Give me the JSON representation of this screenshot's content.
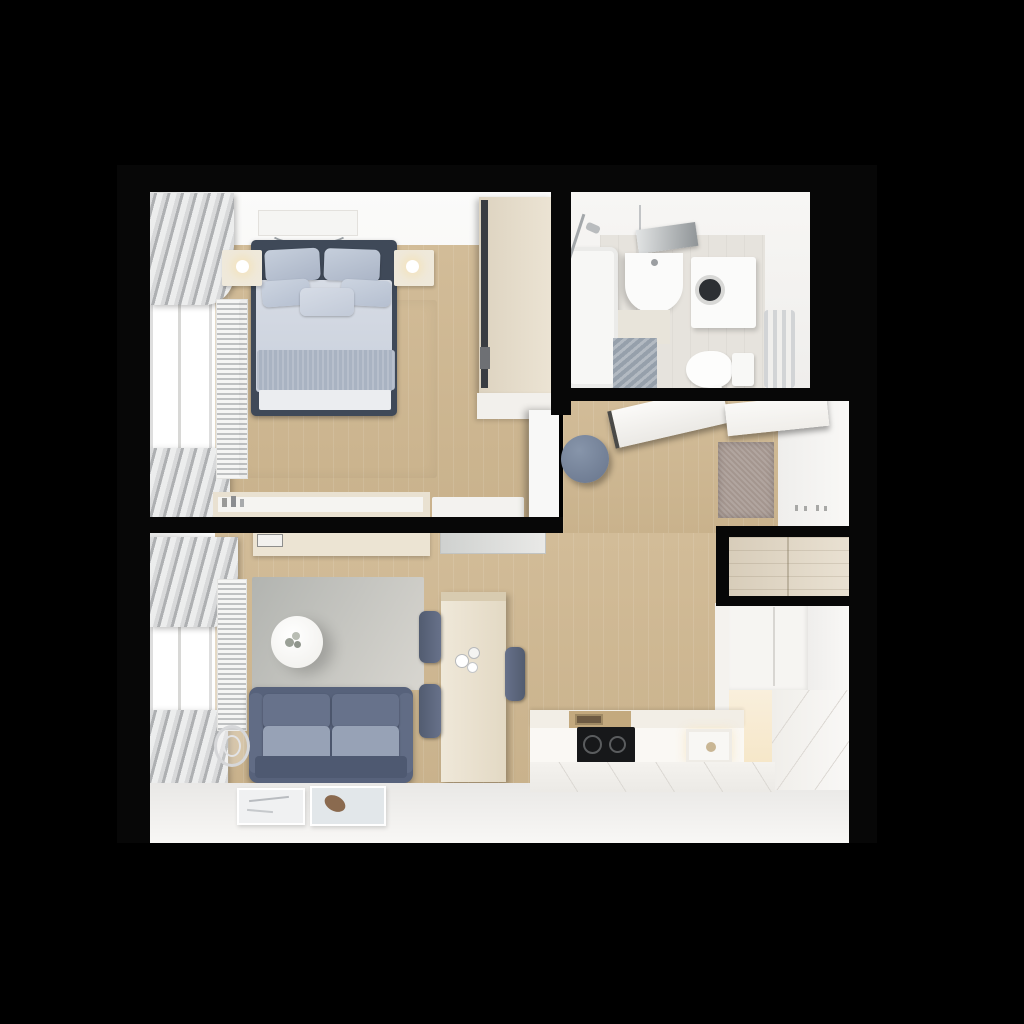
{
  "scene": {
    "description": "Top-down 3D render of a small one-bedroom apartment floor plan on a black background",
    "background_color": "#000000"
  },
  "palette": {
    "wall_black": "#070707",
    "interior_white": "#f2f1ee",
    "wood_floor": "#cdb795",
    "bed_frame": "#3f4958",
    "bedding": "#d2d8e1",
    "pillow": "#b7c1d1",
    "sofa_back": "#67728b",
    "sofa_seat": "#97a2b6",
    "rug_bedroom": "#e4e5e1",
    "rug_living": "#c0c2be",
    "pouf_blue": "#76839a",
    "doormat_mauve": "#a4968f",
    "wardrobe_wood": "#e2d8c6",
    "cooktop_black": "#17181a",
    "counter_cream": "#f2eee6",
    "warm_glow": "#f8edd5"
  },
  "rooms": {
    "bedroom": {
      "label": "Bedroom",
      "items": [
        "double bed with blue-grey bedding",
        "dark headboard",
        "two nightstands with glowing lamps",
        "sliding-door wardrobe",
        "dresser sideboard with bottles",
        "light area rug",
        "radiator",
        "window with grey curtains",
        "ceiling light panel",
        "open white door"
      ]
    },
    "bathroom": {
      "label": "Bathroom",
      "items": [
        "bathtub with shower fixture",
        "vanity sink with mirror",
        "washing machine",
        "toilet",
        "towel radiator",
        "bath mats"
      ]
    },
    "hallway": {
      "label": "Entry hallway",
      "items": [
        "open door panels",
        "round blue pouf",
        "textured doormat",
        "wall hooks",
        "built-in closet"
      ]
    },
    "living_kitchen": {
      "label": "Living room and kitchen",
      "items": [
        "two-seat blue-grey sofa",
        "round white coffee table with plant",
        "grey area rug",
        "TV panel",
        "wood sideboard with clock",
        "dining table with tableware",
        "three dark chairs",
        "radiator",
        "window with grey curtains",
        "wire basket",
        "two framed pictures",
        "L-shaped white kitchen counter",
        "black cooktop",
        "sink",
        "wooden board section",
        "tall fridge unit",
        "lit cabinet niche"
      ]
    }
  }
}
